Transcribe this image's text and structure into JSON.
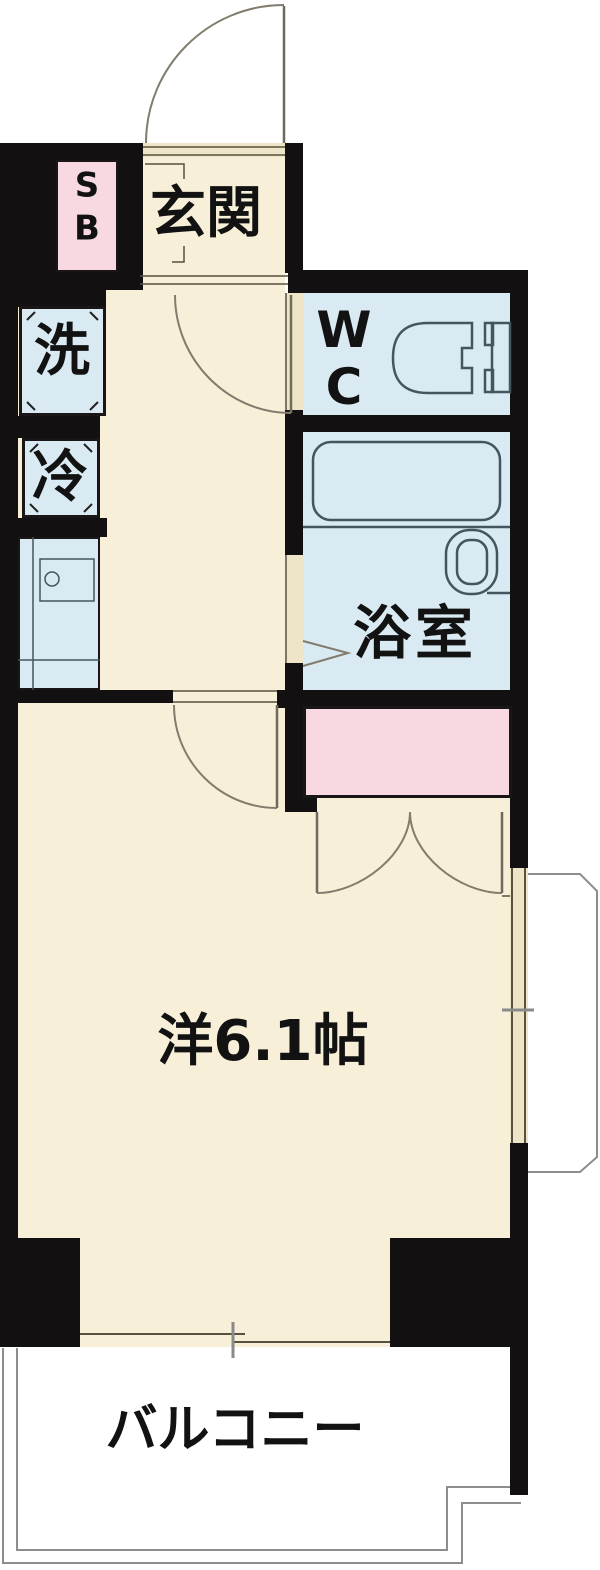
{
  "palette": {
    "wall": "#131011",
    "floor": "#f7efd7",
    "wet": "#daeaf3",
    "pink": "#f8d9e2",
    "door_gap": "#eee5c9",
    "fixture": "#42565f",
    "line": "#57523f",
    "door": "#827c6d",
    "balcony_line": "#8d8d8d",
    "text": "#121212"
  },
  "labels": {
    "genkan": "玄関",
    "shoe_box_s": "S",
    "shoe_box_b": "B",
    "washer": "洗",
    "wc_w": "W",
    "wc_c": "C",
    "fridge": "冷",
    "bathroom": "浴室",
    "main_room": "洋6.1帖",
    "balcony": "バルコニー"
  }
}
